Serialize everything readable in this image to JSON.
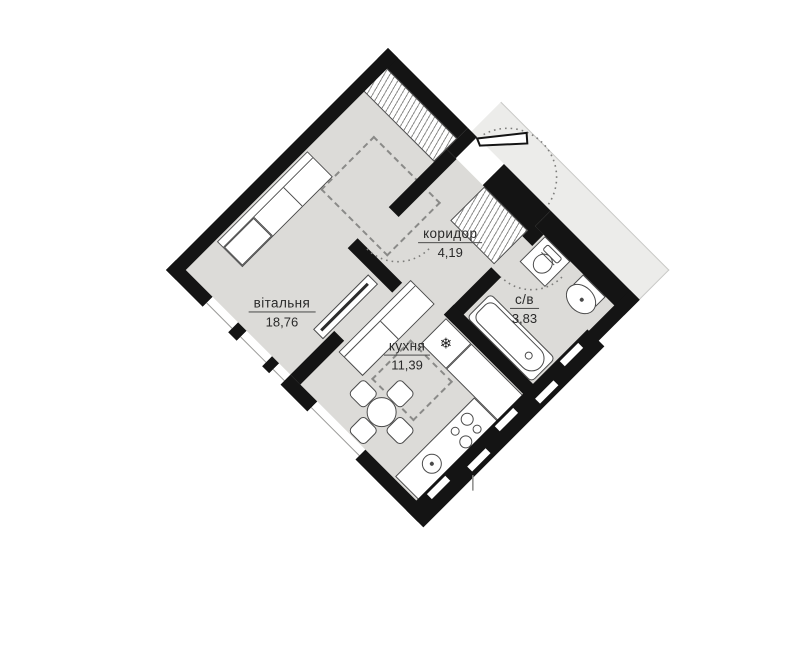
{
  "plan": {
    "title": "apartment-floor-plan",
    "rooms": [
      {
        "id": "living",
        "label": "вітальня",
        "area": "18,76"
      },
      {
        "id": "kitchen",
        "label": "кухня",
        "area": "11,39"
      },
      {
        "id": "corridor",
        "label": "коридор",
        "area": "4,19"
      },
      {
        "id": "bathroom",
        "label": "с/в",
        "area": "3,83"
      }
    ],
    "colors": {
      "wall": "#141414",
      "floor": "#dcdbd8",
      "vestibule": "#ececea",
      "furniture_line": "#4a4a4a",
      "dashed_line": "#8a8a88"
    },
    "fixtures": {
      "fridge_glyph": "❄"
    }
  }
}
